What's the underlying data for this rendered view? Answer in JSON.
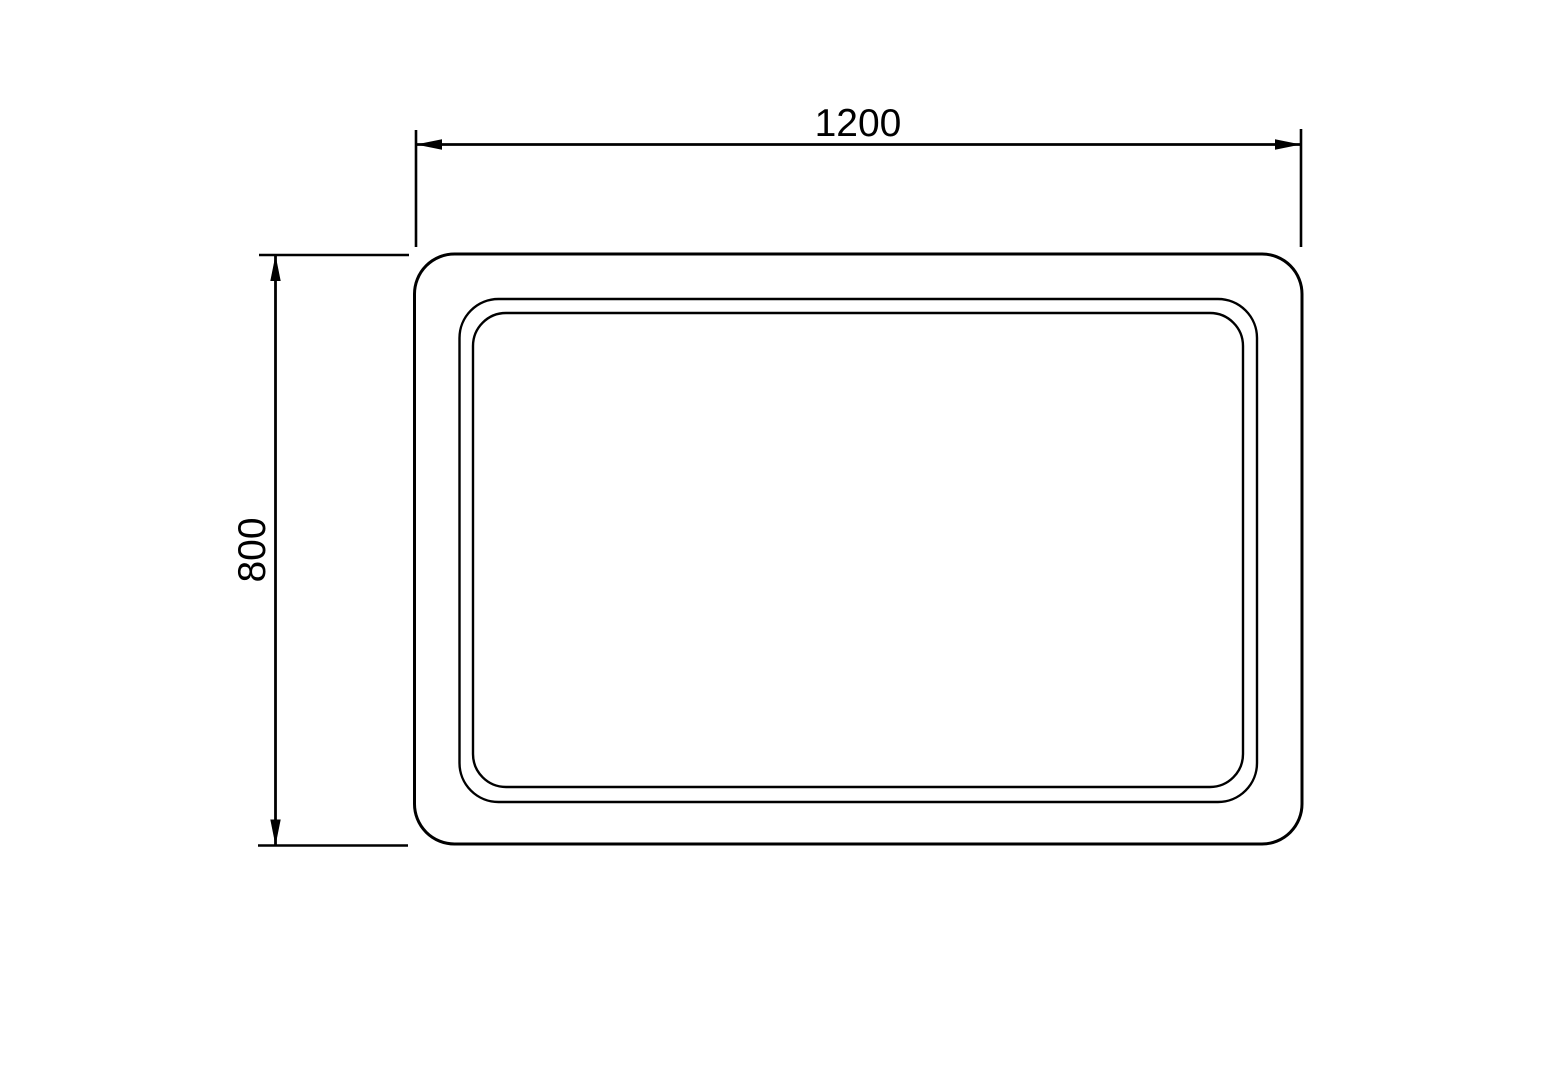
{
  "drawing": {
    "background_color": "#ffffff",
    "line_color": "#000000",
    "dimensions": {
      "width": {
        "label": "1200"
      },
      "height": {
        "label": "800"
      }
    }
  }
}
